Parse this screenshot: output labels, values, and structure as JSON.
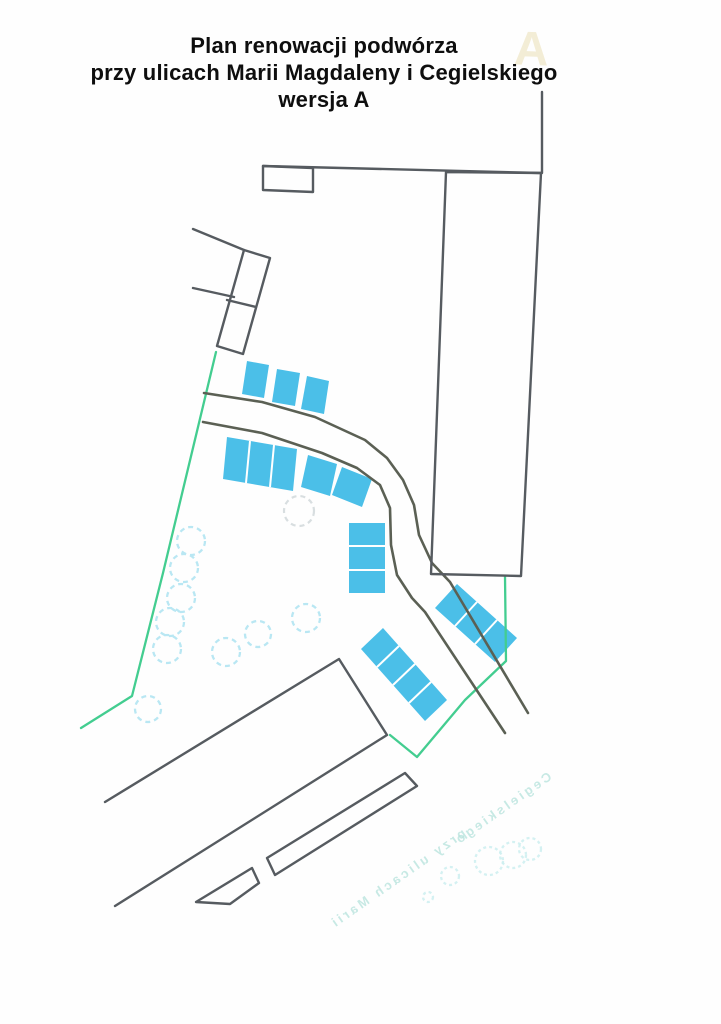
{
  "title": {
    "line1": "Plan renowacji podwórza",
    "line2": "przy ulicach Marii Magdaleny i Cegielskiego",
    "line3": "wersja A"
  },
  "watermark_letter": "A",
  "colors": {
    "parking_fill": "#4bbfe8",
    "boundary_green": "#43cd90",
    "outline_grey": "#565b60",
    "road_grey": "#5b6054",
    "tree_dash": "#b9e7f3",
    "bleedthrough": "#b5e2dc"
  },
  "plan": {
    "shapes": [
      {
        "t": "tx",
        "n": "bleedthrough-text-lower",
        "cls": "ghosttx",
        "x": 400,
        "y": 882,
        "rot": -35,
        "mirror": true,
        "text": "przy ulicach Marii"
      },
      {
        "t": "tx",
        "n": "bleedthrough-text-upper",
        "cls": "ghosttx",
        "x": 505,
        "y": 812,
        "rot": -35,
        "mirror": true,
        "text": "Cegielskiego"
      },
      {
        "t": "c",
        "n": "bleedthrough-circle",
        "cls": "ghostc",
        "x": 489,
        "y": 861,
        "r": 14
      },
      {
        "t": "c",
        "n": "bleedthrough-circle",
        "cls": "ghostc",
        "x": 513,
        "y": 855,
        "r": 13
      },
      {
        "t": "c",
        "n": "bleedthrough-circle",
        "cls": "ghostc",
        "x": 530,
        "y": 849,
        "r": 11
      },
      {
        "t": "c",
        "n": "bleedthrough-circle",
        "cls": "ghostc",
        "x": 450,
        "y": 876,
        "r": 9
      },
      {
        "t": "c",
        "n": "bleedthrough-circle",
        "cls": "ghostc",
        "x": 428,
        "y": 897,
        "r": 5
      },
      {
        "t": "c",
        "n": "tree-circle",
        "cls": "tree",
        "x": 191,
        "y": 541,
        "r": 14
      },
      {
        "t": "c",
        "n": "tree-circle",
        "cls": "tree",
        "x": 184,
        "y": 568,
        "r": 14
      },
      {
        "t": "c",
        "n": "tree-circle",
        "cls": "tree",
        "x": 181,
        "y": 598,
        "r": 14
      },
      {
        "t": "c",
        "n": "tree-circle",
        "cls": "tree",
        "x": 170,
        "y": 622,
        "r": 14
      },
      {
        "t": "c",
        "n": "tree-circle",
        "cls": "tree",
        "x": 167,
        "y": 649,
        "r": 14
      },
      {
        "t": "c",
        "n": "tree-circle",
        "cls": "tree",
        "x": 148,
        "y": 709,
        "r": 13
      },
      {
        "t": "c",
        "n": "tree-circle",
        "cls": "tree",
        "x": 306,
        "y": 618,
        "r": 14
      },
      {
        "t": "c",
        "n": "tree-circle",
        "cls": "tree",
        "x": 258,
        "y": 634,
        "r": 13
      },
      {
        "t": "c",
        "n": "tree-circle",
        "cls": "tree",
        "x": 226,
        "y": 652,
        "r": 14
      },
      {
        "t": "c",
        "n": "tree-circle-faint",
        "cls": "treeg",
        "x": 299,
        "y": 511,
        "r": 15
      },
      {
        "t": "pg",
        "n": "parking-stall",
        "cls": "park",
        "p": "247,361 269,365 264,398 242,394"
      },
      {
        "t": "pg",
        "n": "parking-stall",
        "cls": "park",
        "p": "277,369 300,373 295,406 272,402"
      },
      {
        "t": "pg",
        "n": "parking-stall",
        "cls": "park",
        "p": "307,376 329,381 324,414 301,409"
      },
      {
        "t": "pg",
        "n": "parking-block-three",
        "cls": "park",
        "p": "227,437 297,449 293,491 223,479"
      },
      {
        "t": "pg",
        "n": "parking-stall",
        "cls": "park",
        "p": "308,455 337,464 330,496 301,487"
      },
      {
        "t": "pg",
        "n": "parking-stall",
        "cls": "park",
        "p": "342,467 372,479 362,507 332,495"
      },
      {
        "t": "pg",
        "n": "parking-block-vertical",
        "cls": "park",
        "p": "349,523 385,523 385,593 349,593"
      },
      {
        "t": "pg",
        "n": "parking-block-four-diagonal",
        "cls": "park",
        "p": "383,628 447,700 425,721 361,649"
      },
      {
        "t": "pg",
        "n": "parking-block-three-diagonal",
        "cls": "park",
        "p": "457,584 517,638 495,662 435,608"
      },
      {
        "t": "pl",
        "n": "stall-divider",
        "cls": "pdiv",
        "p": "250,441 246,483"
      },
      {
        "t": "pl",
        "n": "stall-divider",
        "cls": "pdiv",
        "p": "274,445 270,487"
      },
      {
        "t": "pl",
        "n": "stall-divider",
        "cls": "pdiv",
        "p": "349,546 385,546"
      },
      {
        "t": "pl",
        "n": "stall-divider",
        "cls": "pdiv",
        "p": "349,570 385,570"
      },
      {
        "t": "pl",
        "n": "stall-divider",
        "cls": "pdiv",
        "p": "399,646 377,667"
      },
      {
        "t": "pl",
        "n": "stall-divider",
        "cls": "pdiv",
        "p": "415,664 393,685"
      },
      {
        "t": "pl",
        "n": "stall-divider",
        "cls": "pdiv",
        "p": "431,682 409,703"
      },
      {
        "t": "pl",
        "n": "stall-divider",
        "cls": "pdiv",
        "p": "477,602 455,626"
      },
      {
        "t": "pl",
        "n": "stall-divider",
        "cls": "pdiv",
        "p": "497,620 475,644"
      },
      {
        "t": "pl",
        "n": "green-boundary-left",
        "cls": "green",
        "p": "216,352 163,573 132,696 81,728"
      },
      {
        "t": "pl",
        "n": "green-boundary-right",
        "cls": "green",
        "p": "505,576 506,661 465,700 417,757 390,735"
      },
      {
        "t": "pl",
        "n": "road-edge-outer",
        "cls": "road",
        "p": "204,393 262,402 315,417 365,440 387,458 403,480 414,505 419,535 432,563 450,582 528,713"
      },
      {
        "t": "pl",
        "n": "road-edge-inner",
        "cls": "road",
        "p": "203,422 262,433 322,453 357,468 380,485 390,508 391,545 397,575 412,598 425,612 505,733"
      },
      {
        "t": "pl",
        "n": "boundary-top-line",
        "cls": "bld",
        "p": "263,166 541,173"
      },
      {
        "t": "pl",
        "n": "boundary-vertical-line",
        "cls": "bld",
        "p": "542,92 542,173"
      },
      {
        "t": "pg",
        "n": "building-small-annex",
        "cls": "bld",
        "p": "263,166 313,168 313,192 263,190"
      },
      {
        "t": "pg",
        "n": "building-right-long",
        "cls": "bld",
        "p": "446,172 541,173 521,576 431,574"
      },
      {
        "t": "pl",
        "n": "wall-upper-left",
        "cls": "bld",
        "p": "193,229 244,250"
      },
      {
        "t": "pg",
        "n": "building-tilted-left",
        "cls": "bld",
        "p": "244,250 270,258 243,354 217,346"
      },
      {
        "t": "pl",
        "n": "building-tilted-divider",
        "cls": "bld",
        "p": "227,300 256,307"
      },
      {
        "t": "pl",
        "n": "wall-left-lower",
        "cls": "bld",
        "p": "193,288 234,297"
      },
      {
        "t": "pl",
        "n": "building-bottom-large",
        "cls": "bld",
        "p": "105,802 339,659 387,735 115,906"
      },
      {
        "t": "pg",
        "n": "building-narrow-strip",
        "cls": "bld",
        "p": "405,773 417,786 275,875 267,858"
      },
      {
        "t": "pg",
        "n": "building-small-trapezoid",
        "cls": "bld",
        "p": "252,868 259,883 230,904 196,902"
      }
    ]
  }
}
